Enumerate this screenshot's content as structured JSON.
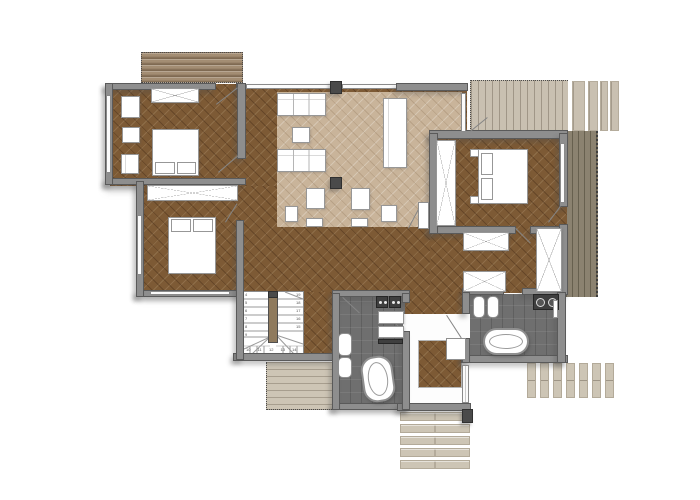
{
  "title": "Residential floor plan — level with three bedrooms, two bathrooms, open living-dining area, U-stair and perimeter wood decks",
  "colors": {
    "background": "#ffffff",
    "floor_wood_dark": "#7d5a35",
    "floor_wood_light": "#c9b49a",
    "wall_fill": "#8e8e8e",
    "wall_border": "#5a5a5a",
    "bath_tile": "#6f6f6f",
    "column_dark": "#4a4a4a",
    "deck_tan": "#a38d73",
    "deck_light": "#c9c0b1",
    "deck_olive": "#8b8270",
    "deck_pale": "#cdc5b5",
    "stair_rail": "#8f7a5d",
    "fixture_dark": "#3f3f3f",
    "furniture_outline": "#979797"
  },
  "stairs": {
    "left_numbers": [
      "4",
      "5",
      "6",
      "7",
      "8",
      "9"
    ],
    "right_numbers": [
      "19",
      "18",
      "17",
      "16",
      "15"
    ],
    "winder_numbers": [
      "10",
      "11",
      "12",
      "13",
      "14"
    ]
  },
  "rooms": [
    {
      "name": "bedroom-upper-left",
      "contents": [
        "wardrobe",
        "double-bed",
        "dresser",
        "side-table",
        "chest"
      ]
    },
    {
      "name": "bedroom-lower-left",
      "contents": [
        "wardrobe",
        "double-bed"
      ]
    },
    {
      "name": "living-dining-area",
      "contents": [
        "sofa",
        "sofa",
        "coffee-table",
        "dining-table",
        "lounge-chairs",
        "structural-columns",
        "area-rug-light-parquet"
      ]
    },
    {
      "name": "bedroom-right",
      "contents": [
        "built-in-closet",
        "double-bed",
        "nightstands"
      ]
    },
    {
      "name": "dressing-room",
      "contents": [
        "closet",
        "closet",
        "tall-closet"
      ]
    },
    {
      "name": "bathroom-main",
      "contents": [
        "double-washbasin",
        "shelves",
        "shower-partition",
        "toilet",
        "bidet",
        "freestanding-oval-bathtub"
      ]
    },
    {
      "name": "bathroom-second",
      "contents": [
        "toilet",
        "bidet",
        "double-basin-counter",
        "oval-bathtub"
      ]
    },
    {
      "name": "staircase",
      "contents": [
        "two-flights",
        "winder-treads",
        "center-rail"
      ]
    },
    {
      "name": "entry-vestibule",
      "contents": [
        "doormat-wood-inset",
        "entry-steps"
      ]
    }
  ],
  "decks": [
    "north-deck",
    "north-east-deck",
    "east-deck",
    "south-deck-by-stairs",
    "south-east-plank-deck",
    "entry-steps"
  ]
}
